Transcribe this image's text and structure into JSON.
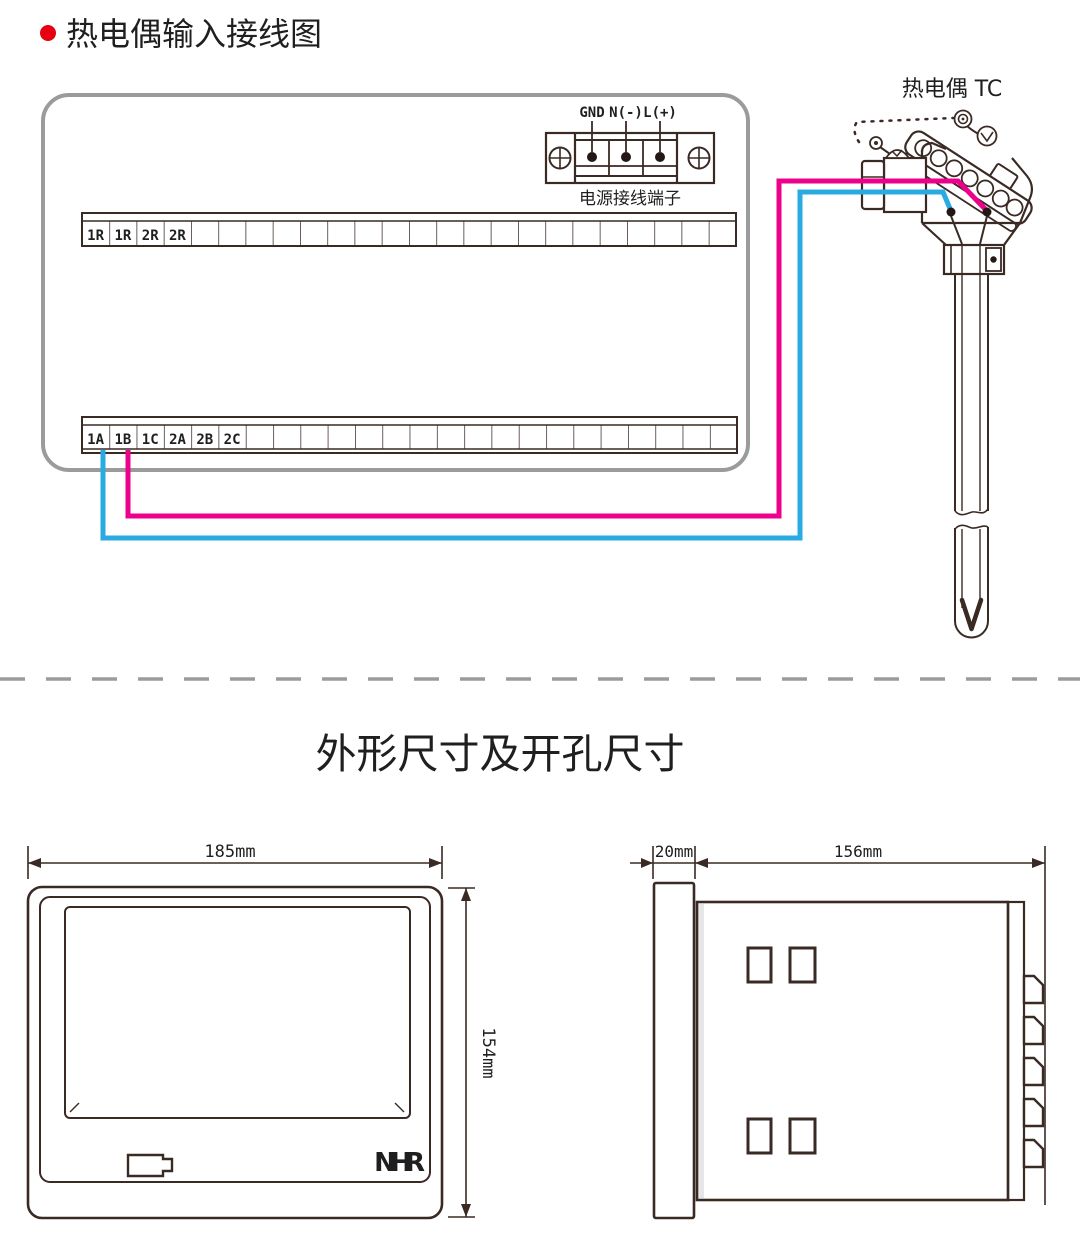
{
  "colors": {
    "line_art": "#3a2a24",
    "box_border": "#9b9b9b",
    "wire_pink": "#ec008c",
    "wire_blue": "#29abe2",
    "bullet_red": "#e60012",
    "logo_gray": "#b5b5b5",
    "logo_red": "#cf3328",
    "text": "#1f1f1f"
  },
  "wiring_section": {
    "title": "热电偶输入接线图",
    "power_terminal": {
      "pin_labels": [
        "GND",
        "N(-)",
        "L(+)"
      ],
      "caption": "电源接线端子"
    },
    "upper_strip_labels": [
      "1R",
      "1R",
      "2R",
      "2R"
    ],
    "lower_strip_labels": [
      "1A",
      "1B",
      "1C",
      "2A",
      "2B",
      "2C"
    ],
    "sensor_label": "热电偶 TC"
  },
  "dimension_section": {
    "title": "外形尺寸及开孔尺寸",
    "front_view": {
      "width": "185mm",
      "height": "154mm",
      "logo": [
        "N",
        "H",
        "R"
      ]
    },
    "side_view": {
      "depth": "20mm",
      "length": "156mm"
    }
  }
}
